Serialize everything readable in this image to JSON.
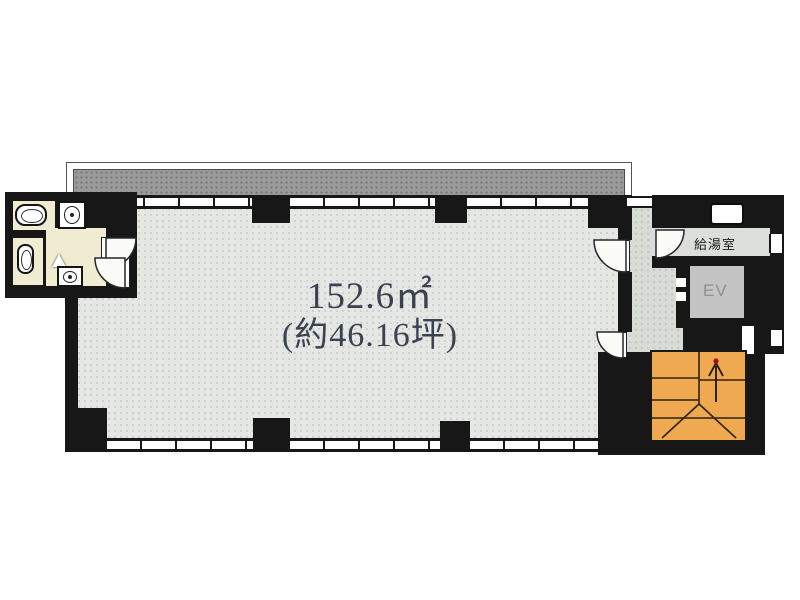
{
  "plan": {
    "labels": {
      "area_m2": "152.6㎡",
      "area_tsubo": "(約46.16坪)",
      "kitchenette": "給湯室",
      "elevator": "EV"
    },
    "stairs": {
      "direction_arrow": "up"
    },
    "colors": {
      "wall": "#171717",
      "main_floor": "#e4e7e3",
      "hall_floor": "#d9dbd7",
      "restroom_floor": "#efecd2",
      "balcony": "#9b9b9b",
      "elevator_car": "#c3c4c3",
      "stairs": "#efa951",
      "text": "#3a4150",
      "background": "#ffffff"
    }
  }
}
